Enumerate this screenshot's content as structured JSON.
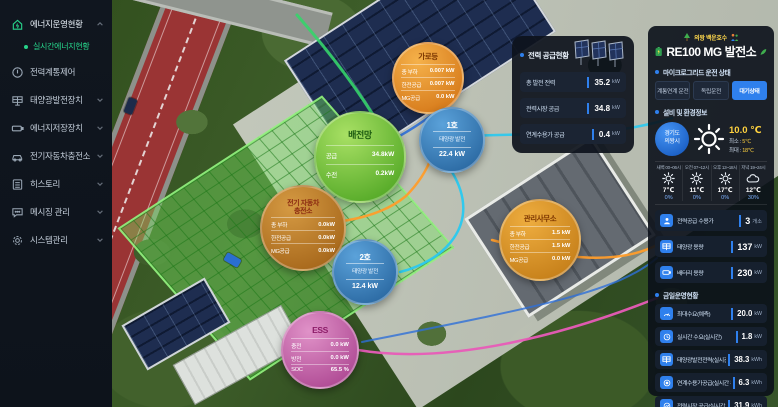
{
  "colors": {
    "accent_blue": "#2f80ed",
    "accent_green": "#27d38a",
    "temp_yellow": "#ffd23f",
    "panel_bg": "#0d121c"
  },
  "sidebar": {
    "items": [
      {
        "label": "에너지운영현황"
      },
      {
        "label": "전력계통제어"
      },
      {
        "label": "태양광발전장치"
      },
      {
        "label": "에너지저장장치"
      },
      {
        "label": "전기자동차충전소"
      },
      {
        "label": "히스토리"
      },
      {
        "label": "메시징 관리"
      },
      {
        "label": "시스템관리"
      }
    ],
    "sub_item": {
      "label": "실시간에너지현황"
    }
  },
  "supply_panel": {
    "title": "전력 공급현황",
    "rows": [
      {
        "label": "총 발전 전력",
        "value": "35.2",
        "unit": "kW"
      },
      {
        "label": "전력시장 공급",
        "value": "34.8",
        "unit": "kW"
      },
      {
        "label": "연계수용가 공급",
        "value": "0.4",
        "unit": "kW"
      }
    ]
  },
  "right_panel": {
    "region": "의왕 백운호수",
    "title": "RE100 MG 발전소",
    "mg_status": {
      "heading": "마이크로그리드 운전 상태",
      "modes": [
        {
          "label": "계통연계 운전"
        },
        {
          "label": "독립운전"
        },
        {
          "label": "대기상태"
        }
      ],
      "active_mode": "대기상태"
    },
    "env": {
      "heading": "설비 및 환경정보",
      "location_line1": "경기도",
      "location_line2": "의왕시",
      "temp": "10.0 ℃",
      "min_label": "최소 :",
      "min_value": "5℃",
      "max_label": "최대 :",
      "max_value": "18℃",
      "forecast": [
        {
          "time": "새벽 00~06시",
          "icon": "sun",
          "temp": "7℃",
          "rain": "0%"
        },
        {
          "time": "오전 07~12시",
          "icon": "sun",
          "temp": "11℃",
          "rain": "0%"
        },
        {
          "time": "오후 13~18시",
          "icon": "sun",
          "temp": "17℃",
          "rain": "0%"
        },
        {
          "time": "저녁 19~24시",
          "icon": "cloud",
          "temp": "12℃",
          "rain": "30%"
        }
      ],
      "stats": [
        {
          "label": "전력공급 수용가",
          "value": "3",
          "unit": "개소"
        },
        {
          "label": "태양광 용량",
          "value": "137",
          "unit": "kW"
        },
        {
          "label": "배터리 용량",
          "value": "230",
          "unit": "kW"
        }
      ]
    },
    "today": {
      "heading": "금일운영현황",
      "rows": [
        {
          "label": "최대수요(예측)",
          "value": "20.0",
          "unit": "kW"
        },
        {
          "label": "실시간 수요(실시간)",
          "value": "1.8",
          "unit": "kW"
        },
        {
          "label": "태양광발전전력(실시간 누계)",
          "value": "38.3",
          "unit": "kWh"
        },
        {
          "label": "연계수용가공급(실시간 누계)",
          "value": "6.3",
          "unit": "kWh"
        },
        {
          "label": "전력시장 공급(실시간 누계)",
          "value": "31.9",
          "unit": "kWh"
        }
      ]
    }
  },
  "map": {
    "bubbles": {
      "streetlight": {
        "title": "가로등",
        "rows": [
          {
            "label": "총 부하",
            "value": "0.007 kW"
          },
          {
            "label": "한전공급",
            "value": "0.007 kW"
          },
          {
            "label": "MG공급",
            "value": "0.0 kW"
          }
        ]
      },
      "grid": {
        "title": "배전망",
        "rows": [
          {
            "label": "공급",
            "value": "34.8kW"
          },
          {
            "label": "수전",
            "value": "0.2kW"
          }
        ]
      },
      "pv1": {
        "title": "1호",
        "sub": "태양광 발전",
        "value": "22.4 kW"
      },
      "pv2": {
        "title": "2호",
        "sub": "태양광 발전",
        "value": "12.4 kW"
      },
      "ev": {
        "title_line1": "전기 자동차",
        "title_line2": "충전소",
        "rows": [
          {
            "label": "총 부하",
            "value": "0.0kW"
          },
          {
            "label": "한전공급",
            "value": "0.0kW"
          },
          {
            "label": "MG공급",
            "value": "0.0kW"
          }
        ]
      },
      "office": {
        "title": "관리사무소",
        "rows": [
          {
            "label": "총 부하",
            "value": "1.5 kW"
          },
          {
            "label": "한전공급",
            "value": "1.5 kW"
          },
          {
            "label": "MG공급",
            "value": "0.0 kW"
          }
        ]
      },
      "ess": {
        "title": "ESS",
        "rows": [
          {
            "label": "충전",
            "value": "0.0 kW"
          },
          {
            "label": "방전",
            "value": "0.0 kW"
          },
          {
            "label": "SOC",
            "value": "65.5 %"
          }
        ]
      }
    }
  }
}
